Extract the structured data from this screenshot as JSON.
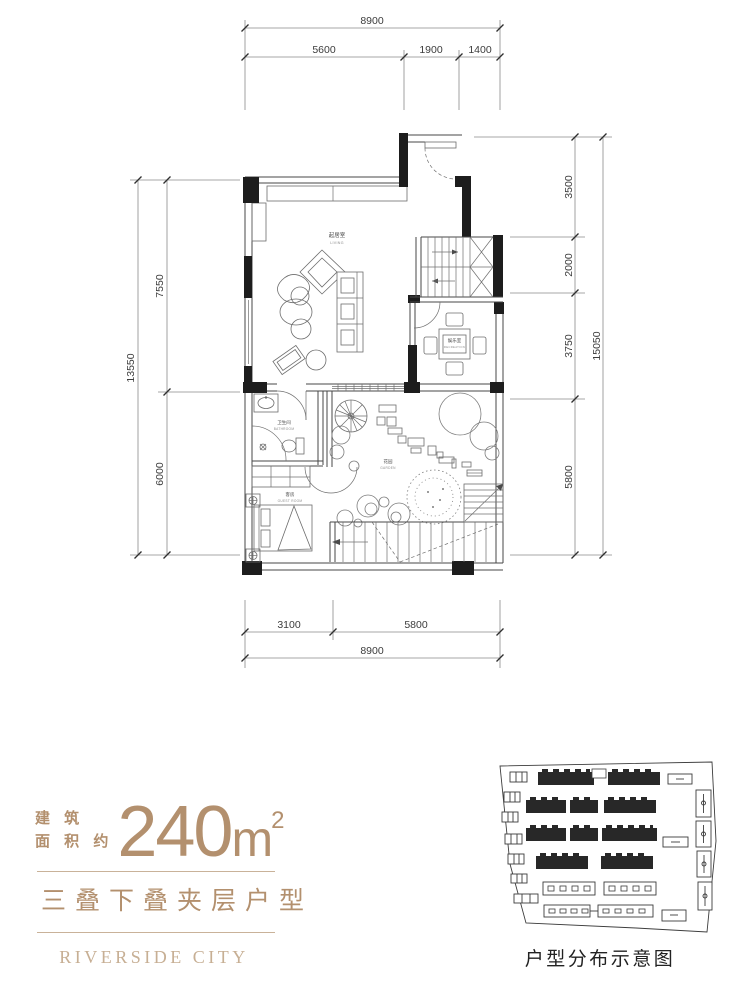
{
  "dims": {
    "top_total": "8900",
    "top_s1": "5600",
    "top_s2": "1900",
    "top_s3": "1400",
    "left_total": "13550",
    "left_s1": "7550",
    "left_s2": "6000",
    "right_total": "15050",
    "right_s1": "3500",
    "right_s2": "2000",
    "right_s3": "3750",
    "right_s4": "5800",
    "bottom_total": "8900",
    "bottom_s1": "3100",
    "bottom_s2": "5800"
  },
  "rooms": {
    "living_zh": "起居室",
    "living_en": "LIVING",
    "recreation_zh": "娱乐室",
    "recreation_en": "RECREATION",
    "bathroom_zh": "卫生间",
    "bathroom_en": "BATHROOM",
    "guest_zh": "客房",
    "guest_en": "GUEST ROOM",
    "garden_zh": "花园",
    "garden_en": "GARDEN"
  },
  "info": {
    "area_label_1": "建 筑",
    "area_label_2": "面 积 约",
    "area_value": "240",
    "area_unit": "m",
    "area_sup": "2",
    "unit_type": "三叠下叠夹层户型",
    "brand": "RIVERSIDE CITY"
  },
  "site": {
    "caption": "户型分布示意图"
  },
  "colors": {
    "accent": "#b3906e",
    "accent_light": "#c7af94",
    "plan_line": "#474747",
    "wall_fill": "#1d1d1d",
    "background": "#ffffff"
  }
}
